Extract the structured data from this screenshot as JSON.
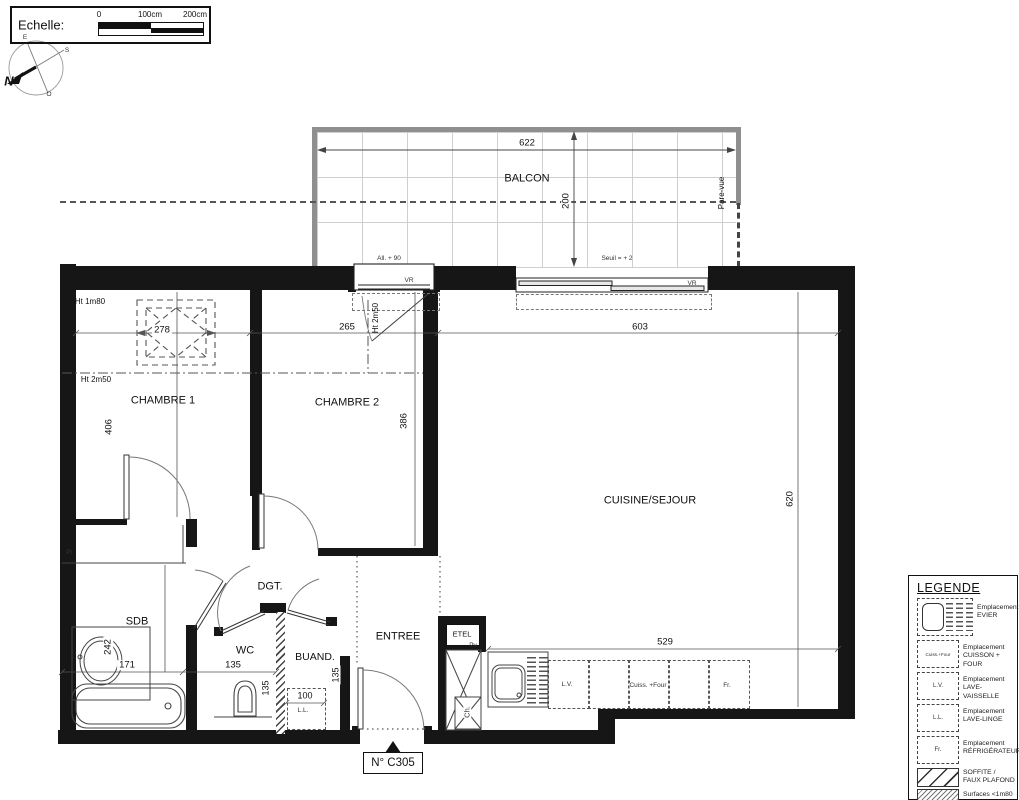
{
  "scalebar": {
    "label": "Echelle:",
    "tick0": "0",
    "tick100": "100cm",
    "tick200": "200cm"
  },
  "compass": {
    "n": "N",
    "e": "E",
    "s": "S",
    "o": "O"
  },
  "balcony": {
    "label": "BALCON",
    "width": "622",
    "depth": "200",
    "pare_vue": "Pare-vue",
    "allege": "All. + 90",
    "seuil": "Seuil = + 2",
    "vr": "VR"
  },
  "rooms": {
    "chambre1": {
      "label": "CHAMBRE 1",
      "width": "278",
      "depth": "406",
      "ht1": "Ht 1m80",
      "ht2": "Ht 2m50"
    },
    "chambre2": {
      "label": "CHAMBRE 2",
      "width": "265",
      "depth": "386",
      "ht": "Ht 2m50"
    },
    "cuisine": {
      "label": "CUISINE/SEJOUR",
      "width": "603",
      "depth": "620",
      "counter": "529",
      "lv": "L.V.",
      "cuisson": "Cuiss. +Four",
      "frigo": "Fr."
    },
    "sdb": {
      "label": "SDB",
      "width": "171",
      "depth": "242",
      "placard": "Pl"
    },
    "dgt": {
      "label": "DGT."
    },
    "wc": {
      "label": "WC",
      "width": "135",
      "depth": "135"
    },
    "buanderie": {
      "label": "BUAND.",
      "depth": "135",
      "ll_width": "100",
      "ll": "L.L."
    },
    "entree": {
      "label": "ENTREE",
      "etel": "ETEL",
      "pv": "Pv",
      "ch": "Ch."
    }
  },
  "unit": {
    "number": "N° C305"
  },
  "legend": {
    "title": "LEGENDE",
    "evier": {
      "line1": "Emplacement",
      "line2": "EVIER"
    },
    "cuisson": {
      "box": "Cuiss.+Four",
      "line1": "Emplacement",
      "line2": "CUISSON + FOUR"
    },
    "lv": {
      "box": "L.V.",
      "line1": "Emplacement",
      "line2": "LAVE-VAISSELLE"
    },
    "ll": {
      "box": "L.L.",
      "line1": "Emplacement",
      "line2": "LAVE-LINGE"
    },
    "frigo": {
      "box": "Fr.",
      "line1": "Emplacement",
      "line2": "RÉFRIGÉRATEUR"
    },
    "soffite": {
      "line1": "SOFFITE /",
      "line2": "FAUX PLAFOND"
    },
    "surfaces": {
      "line1": "Surfaces <1m80"
    }
  },
  "colors": {
    "wall": "#161616",
    "balcony_edge": "#8f8f8f",
    "line": "#3a3a3a"
  }
}
